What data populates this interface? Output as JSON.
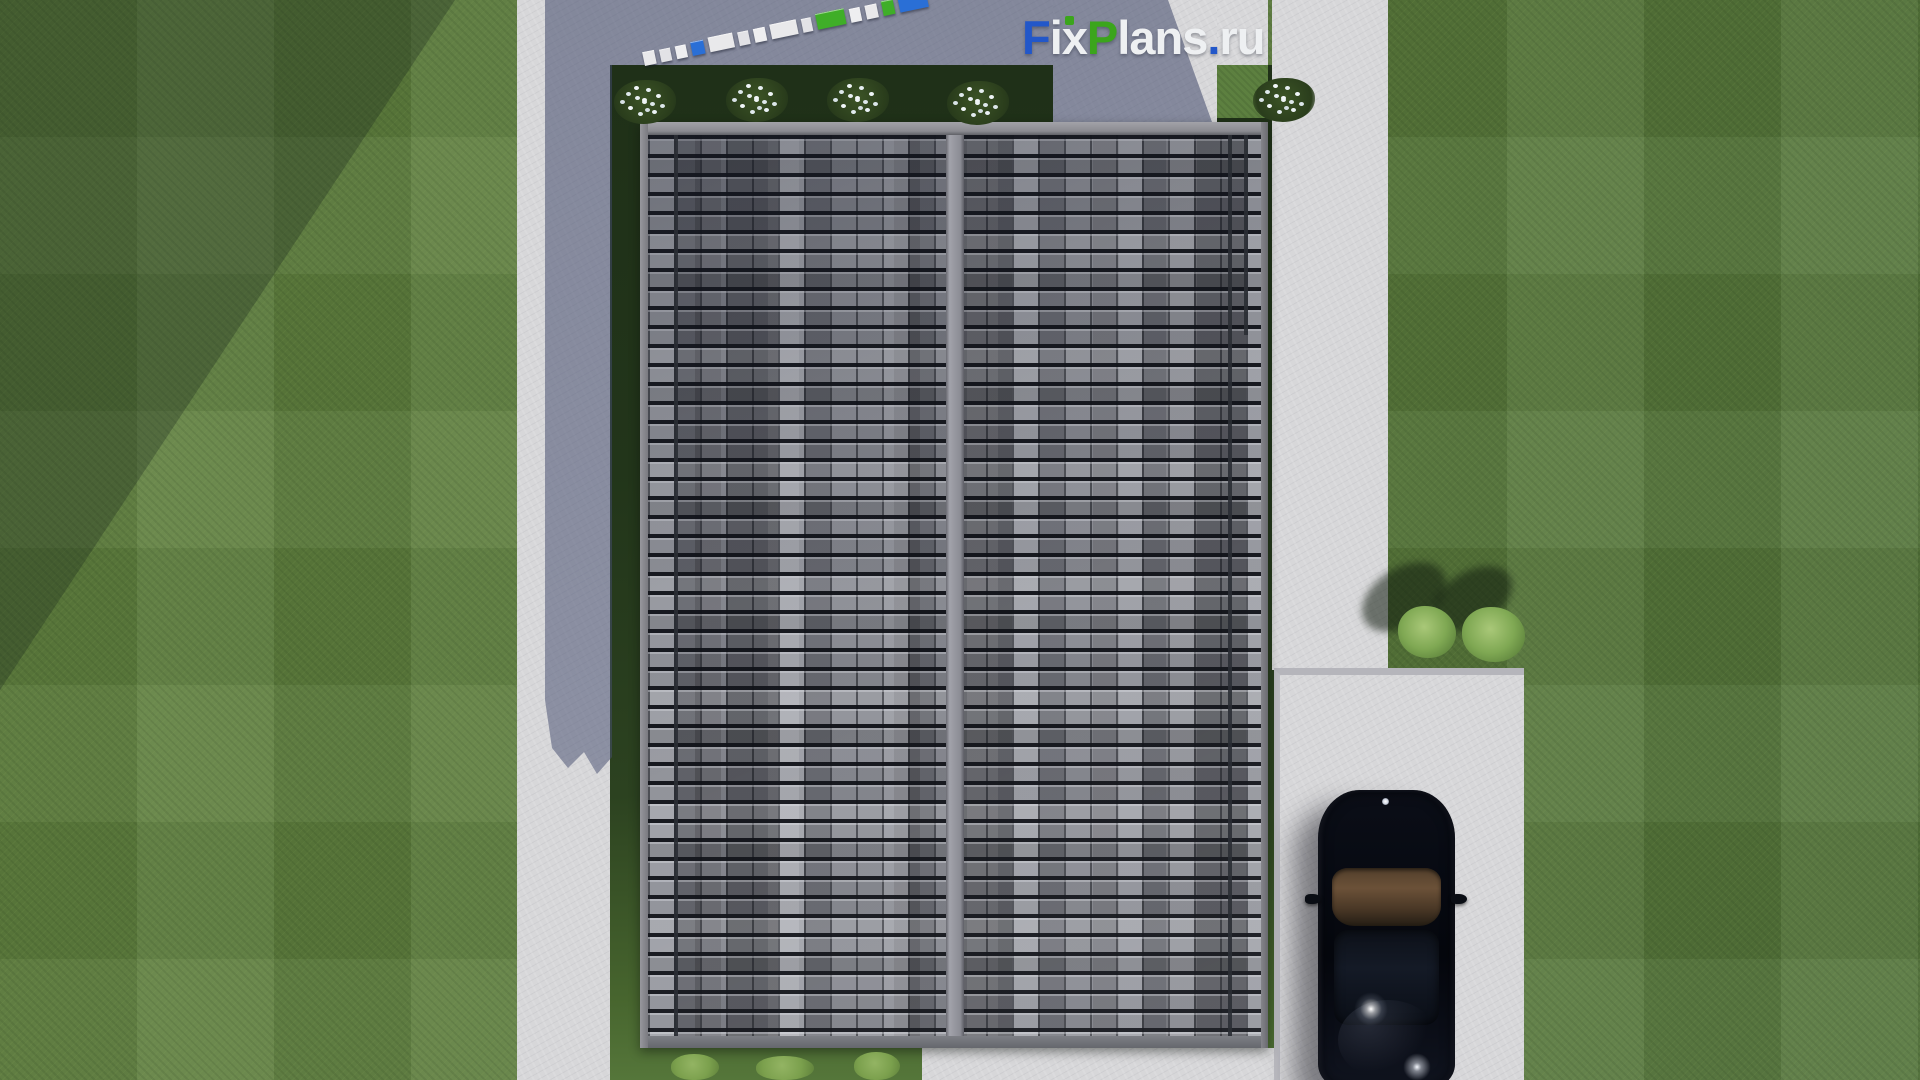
{
  "watermark": {
    "text": "FixPlans.ru",
    "letters": [
      {
        "ch": "F",
        "color": "#2257c9"
      },
      {
        "ch": "i",
        "color": "#eef0f2"
      },
      {
        "ch": "x",
        "color": "#eef0f2"
      },
      {
        "ch": "P",
        "color": "#3ba51c"
      },
      {
        "ch": "l",
        "color": "#eef0f2"
      },
      {
        "ch": "a",
        "color": "#eef0f2"
      },
      {
        "ch": "n",
        "color": "#eef0f2"
      },
      {
        "ch": "s",
        "color": "#eef0f2"
      },
      {
        "ch": ".",
        "color": "#2257c9"
      },
      {
        "ch": "r",
        "color": "#eef0f2"
      },
      {
        "ch": "u",
        "color": "#eef0f2"
      }
    ],
    "i_dot_color": "#3ba51c"
  },
  "garden_blocks": {
    "items": [
      {
        "color": "#e9e9eb",
        "w": 13,
        "h": 14
      },
      {
        "color": "#e2e2e6",
        "w": 11,
        "h": 13
      },
      {
        "color": "#eeeef0",
        "w": 11,
        "h": 13
      },
      {
        "color": "#2a6fd6",
        "w": 14,
        "h": 14
      },
      {
        "color": "#e9e9eb",
        "w": 26,
        "h": 15
      },
      {
        "color": "#e2e2e6",
        "w": 12,
        "h": 14
      },
      {
        "color": "#eeeef0",
        "w": 12,
        "h": 14
      },
      {
        "color": "#e9e9eb",
        "w": 28,
        "h": 15
      },
      {
        "color": "#e2e2e6",
        "w": 11,
        "h": 14
      },
      {
        "color": "#3fae28",
        "w": 30,
        "h": 16
      },
      {
        "color": "#eeeef0",
        "w": 12,
        "h": 14
      },
      {
        "color": "#e9e9eb",
        "w": 12,
        "h": 14
      },
      {
        "color": "#3fae28",
        "w": 13,
        "h": 15
      },
      {
        "color": "#2a6fd6",
        "w": 30,
        "h": 22
      }
    ]
  },
  "palette": {
    "grass": "#5b7b3b",
    "grass_shaded": "#22351a",
    "concrete_lit": "#d7d7d9",
    "concrete_shadow": "#646c92",
    "roof_tile_base": "#71737b",
    "roof_tile_dark": "#1a1c22",
    "roof_tile_light": "#a9abb3",
    "roof_ridge": "#96979f",
    "car_body": "#070a12",
    "car_glass_reflection": "#6b5138",
    "bush_green": "#7fa853",
    "flower_white": "#eef4f6"
  },
  "scene_items": [
    "lawn",
    "house-roof-top-view",
    "roof-ridge",
    "left-walkway",
    "top-walkway",
    "right-walkway",
    "parking-pad",
    "black-car",
    "flowering-bushes",
    "green-bushes",
    "garden-block-border",
    "watermark-logo"
  ]
}
